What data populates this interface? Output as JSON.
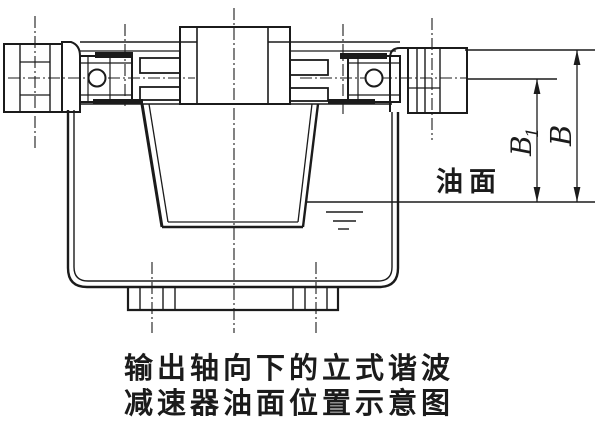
{
  "figure": {
    "caption": {
      "line1": "输出轴向下的立式谐波",
      "line2": "减速器油面位置示意图"
    },
    "labels": {
      "oil_surface": "油面",
      "dim_b1_main": "B",
      "dim_b1_sub": "1",
      "dim_b": "B"
    },
    "dimensions": [
      {
        "name": "B1",
        "from": "bearing-axis-plane",
        "to": "oil-level"
      },
      {
        "name": "B",
        "from": "top-mounting-surface",
        "to": "oil-level"
      }
    ],
    "colors": {
      "ink": "#1b1b1b",
      "paper": "#ffffff"
    }
  }
}
